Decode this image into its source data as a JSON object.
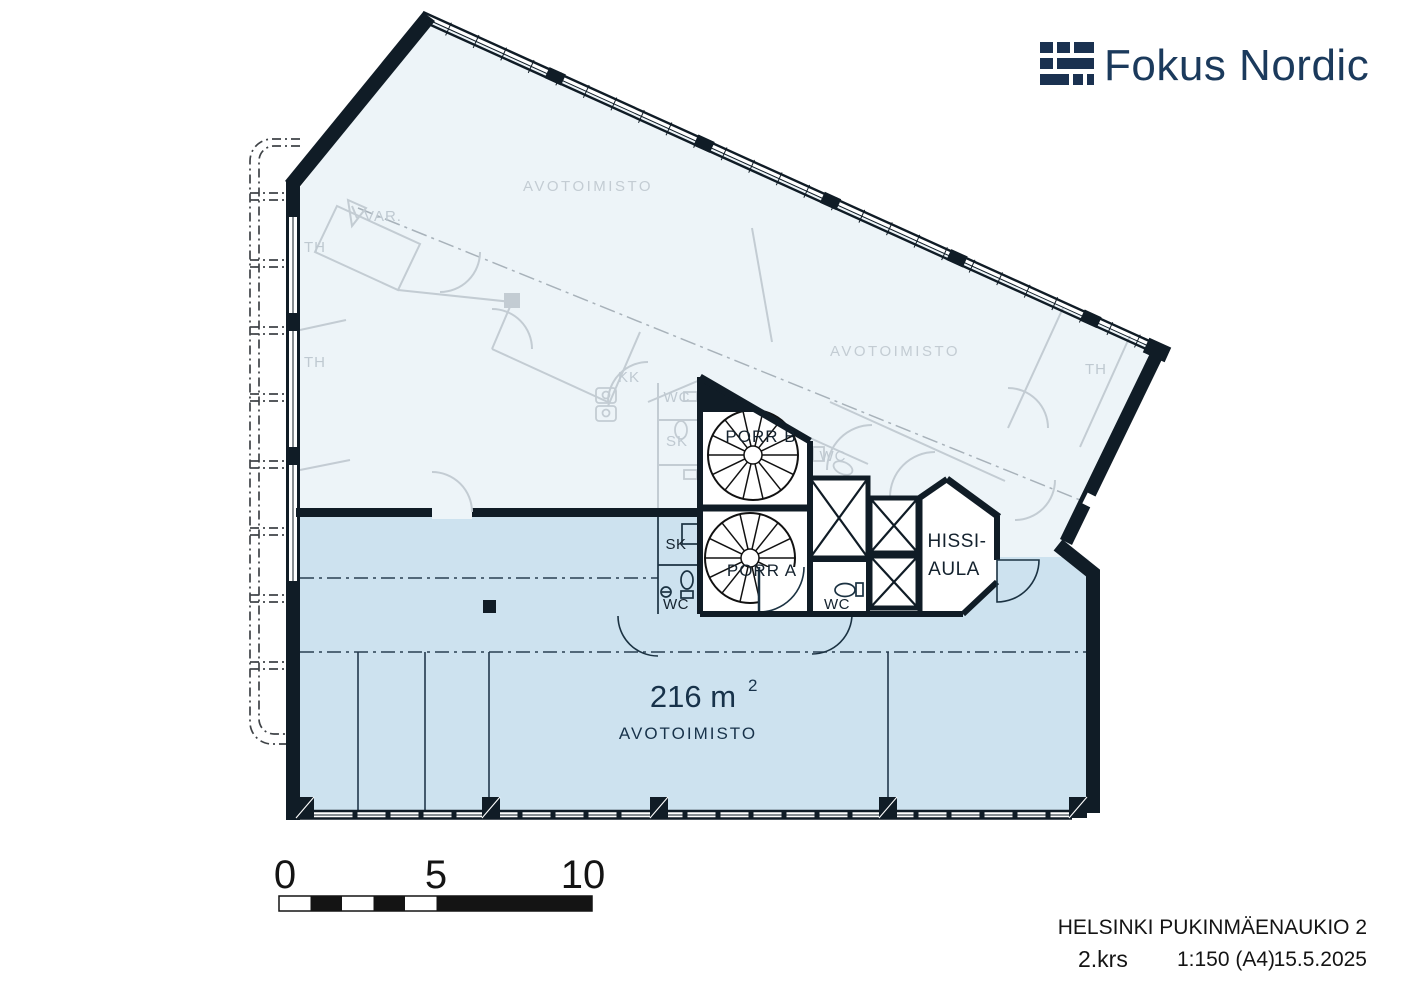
{
  "logo": {
    "text": "Fokus Nordic"
  },
  "plan": {
    "area": {
      "value": "216 m",
      "superscript": "2",
      "room_type": "AVOTOIMISTO"
    },
    "labels": {
      "avotoimisto": "AVOTOIMISTO",
      "var": "VAR.",
      "th": "TH",
      "kk": "KK",
      "wc": "WC",
      "sk": "SK",
      "porr_a": "PORR A",
      "porr_b": "PORR B",
      "hissi_line1": "HISSI-",
      "hissi_line2": "AULA"
    },
    "colors": {
      "unit_fill": "#cde2ef",
      "context_fill": "#edf4f8",
      "wall": "#101c26",
      "context_line": "#c3ccd3",
      "navy_text": "#17324a",
      "logo_navy": "#1b3a5c"
    }
  },
  "scale_bar": {
    "ticks": [
      "0",
      "5",
      "10"
    ]
  },
  "title_block": {
    "project": "HELSINKI PUKINMÄENAUKIO 2",
    "floor": "2.krs",
    "scale": "1:150 (A4)",
    "date": "15.5.2025"
  }
}
